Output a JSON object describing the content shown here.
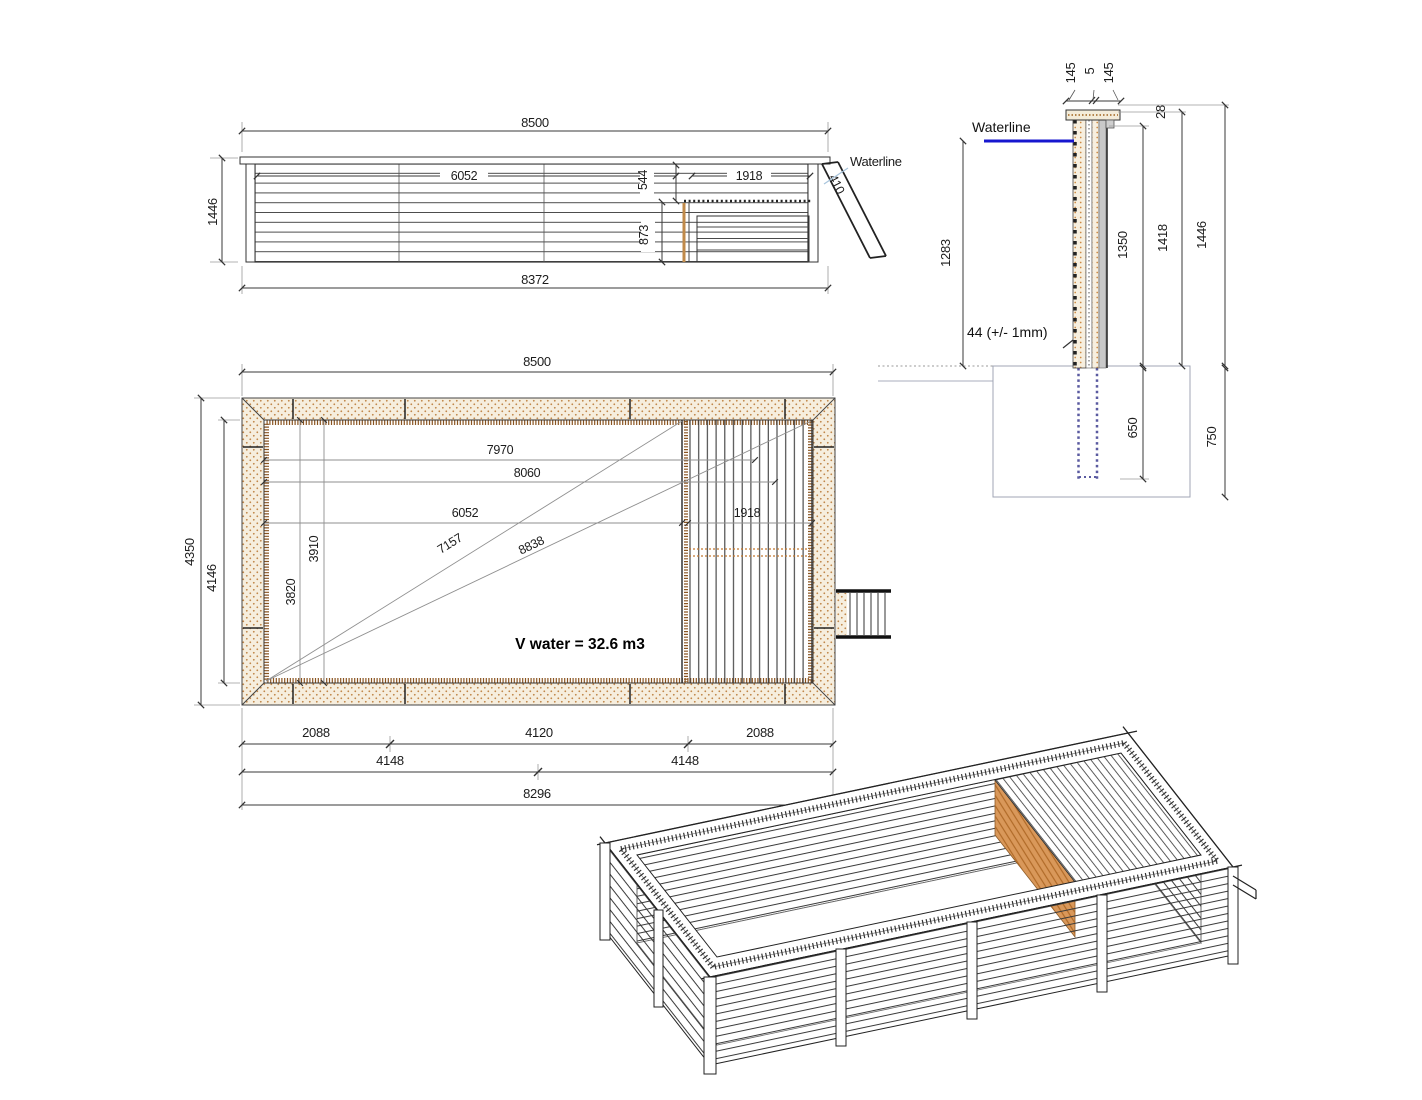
{
  "side_view": {
    "dim_top_width": "8500",
    "dim_height": "1446",
    "dim_bottom_width": "8372",
    "dim_inner_length": "6052",
    "dim_platform_drop": "544",
    "dim_platform_length": "1918",
    "dim_under_platform": "873",
    "dim_ladder": "410",
    "waterline_label": "Waterline"
  },
  "plan_view": {
    "dim_top_width": "8500",
    "dim_outer_height": "4350",
    "dim_inner_height": "4146",
    "dim_len_7970": "7970",
    "dim_len_8060": "8060",
    "dim_len_6052": "6052",
    "dim_diag_7157": "7157",
    "dim_diag_8838": "8838",
    "dim_platform_width": "1918",
    "dim_v_3910": "3910",
    "dim_v_3820": "3820",
    "dim_bottom_left_2088": "2088",
    "dim_bottom_mid_4120": "4120",
    "dim_bottom_right_2088": "2088",
    "dim_bottom_4148_left": "4148",
    "dim_bottom_4148_right": "4148",
    "dim_bottom_total_8296": "8296",
    "volume_note": "V water = 32.6 m3"
  },
  "section_view": {
    "dim_cap_145_left": "145",
    "dim_cap_5": "5",
    "dim_cap_145_right": "145",
    "dim_cap_28": "28",
    "waterline_label": "Waterline",
    "dim_waterline_1283": "1283",
    "plank_note": "44 (+/- 1mm)",
    "dim_1350": "1350",
    "dim_1418": "1418",
    "dim_1446": "1446",
    "dim_buried_650": "650",
    "dim_foundation_750": "750"
  },
  "colors": {
    "waterline_blue": "#1717cf",
    "leader_blue": "#a8c4dc",
    "wood_stipple": "#c08648",
    "wood_edge": "#8a5420",
    "deck_orange": "#d9985a",
    "line_dark": "#222222",
    "line_gray": "#999999",
    "foundation_gray": "#a0a6b5",
    "buried_dotted": "#5a5aa0"
  }
}
